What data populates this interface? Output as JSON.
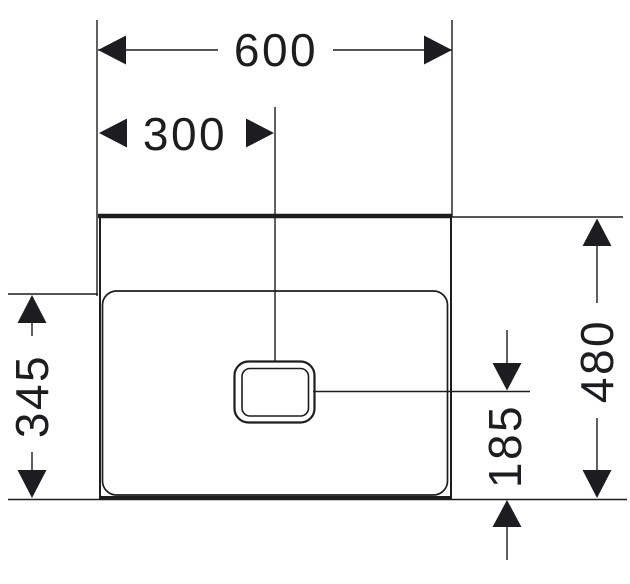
{
  "drawing": {
    "type": "technical-dimension-drawing",
    "background_color": "#ffffff",
    "line_color": "#1d1d1f",
    "unit_note": "",
    "dimensions": {
      "width": "600",
      "drain_center_offset": "300",
      "apron_height": "345",
      "total_height": "480",
      "drain_height": "185"
    }
  }
}
